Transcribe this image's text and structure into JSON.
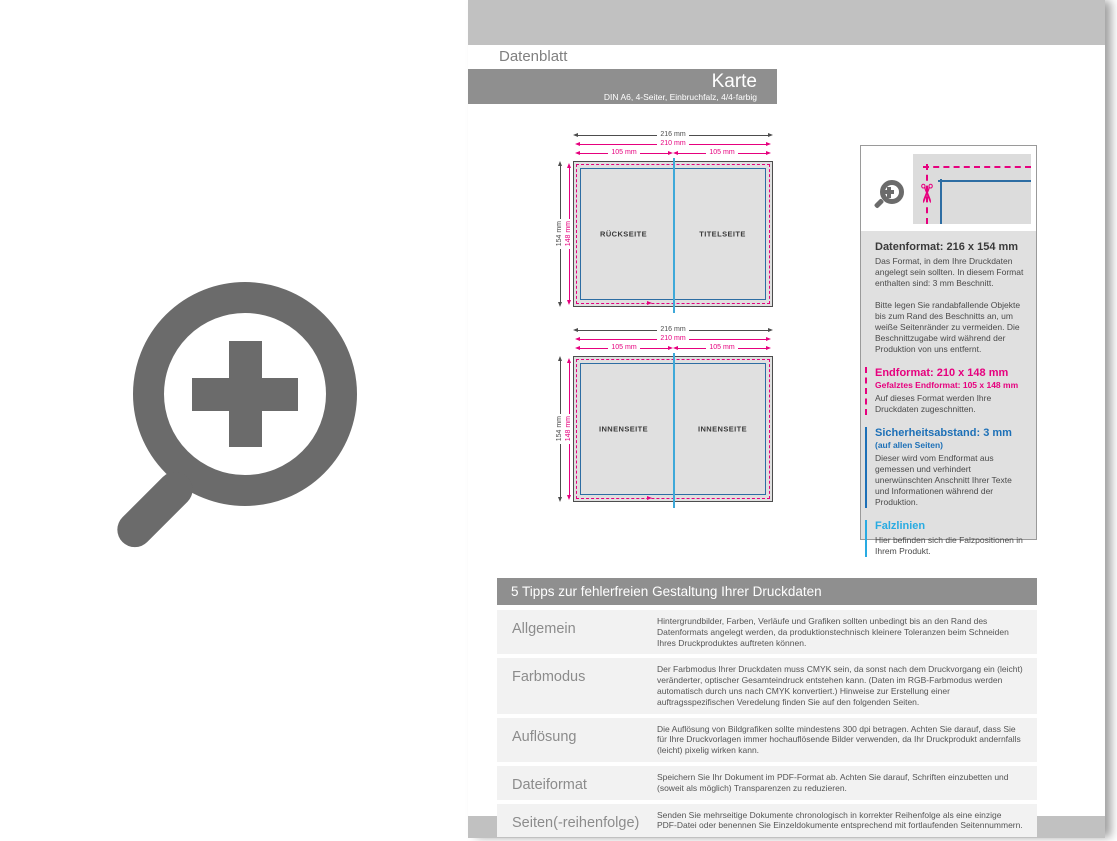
{
  "header": {
    "tab_label": "Datenblatt",
    "title": "Karte",
    "subtitle": "DIN A6, 4-Seiter, Einbruchfalz, 4/4-farbig"
  },
  "diagrams": [
    {
      "dims": {
        "outer_w": "216 mm",
        "end_w": "210 mm",
        "half_left": "105 mm",
        "half_right": "105 mm",
        "outer_h": "154 mm",
        "end_h": "148 mm"
      },
      "left_label": "RÜCKSEITE",
      "right_label": "TITELSEITE"
    },
    {
      "dims": {
        "outer_w": "216 mm",
        "end_w": "210 mm",
        "half_left": "105 mm",
        "half_right": "105 mm",
        "outer_h": "154 mm",
        "end_h": "148 mm"
      },
      "left_label": "INNENSEITE",
      "right_label": "INNENSEITE"
    }
  ],
  "infobox": {
    "sections": [
      {
        "heading": "Datenformat: 216 x 154 mm",
        "body1": "Das Format, in dem Ihre Druckdaten angelegt sein sollten. In diesem Format enthalten sind: 3 mm Beschnitt.",
        "body2": "Bitte legen Sie randabfallende Objekte bis zum Rand des Beschnitts an, um weiße Seitenränder zu vermeiden. Die Beschnittzugabe wird während der Produktion von uns entfernt."
      },
      {
        "heading": "Endformat: 210 x 148 mm",
        "subheading": "Gefalztes Endformat: 105 x 148 mm",
        "body1": "Auf dieses Format werden Ihre Druckdaten zugeschnitten."
      },
      {
        "heading": "Sicherheitsabstand: 3 mm",
        "subheading": "(auf allen Seiten)",
        "body1": "Dieser wird vom Endformat aus gemessen und verhindert unerwünschten Anschnitt Ihrer Texte und Informationen während der Produktion."
      },
      {
        "heading": "Falzlinien",
        "body1": "Hier befinden sich die Falzpositionen in Ihrem Produkt."
      }
    ]
  },
  "tips": {
    "header": "5 Tipps zur fehlerfreien Gestaltung Ihrer Druckdaten",
    "rows": [
      {
        "label": "Allgemein",
        "text": "Hintergrundbilder, Farben, Verläufe und Grafiken sollten unbedingt bis an den Rand des Datenformats angelegt werden, da produktionstechnisch kleinere Toleranzen beim Schneiden Ihres Druckproduktes auftreten können."
      },
      {
        "label": "Farbmodus",
        "text": "Der Farbmodus Ihrer Druckdaten muss CMYK sein, da sonst nach dem Druckvorgang ein (leicht) veränderter, optischer Gesamteindruck entstehen kann. (Daten im RGB-Farbmodus werden automatisch durch uns nach CMYK konvertiert.) Hinweise zur Erstellung einer auftragsspezifischen Veredelung finden Sie auf den folgenden Seiten."
      },
      {
        "label": "Auflösung",
        "text": "Die Auflösung von Bildgrafiken sollte mindestens 300 dpi betragen. Achten Sie darauf, dass Sie für Ihre Druckvorlagen immer hochauflösende Bilder verwenden, da Ihr Druckprodukt andernfalls (leicht) pixelig wirken kann."
      },
      {
        "label": "Dateiformat",
        "text": "Speichern Sie Ihr Dokument im PDF-Format ab. Achten Sie darauf, Schriften einzubetten und (soweit als möglich) Transparenzen zu reduzieren."
      },
      {
        "label": "Seiten(-reihenfolge)",
        "text": "Senden Sie mehrseitige Dokumente chronologisch in korrekter Reihenfolge als eine einzige PDF-Datei oder benennen Sie Einzeldokumente entsprechend mit fortlaufenden Seitennummern."
      }
    ]
  },
  "icons": {
    "scissors": "✂"
  },
  "colors": {
    "magenta": "#e6007e",
    "safety_blue": "#1d70b7",
    "fold_cyan": "#29abe2",
    "band_gray": "#c1c1c1",
    "bar_gray": "#8f8f8f",
    "icon_gray": "#6b6b6b"
  }
}
